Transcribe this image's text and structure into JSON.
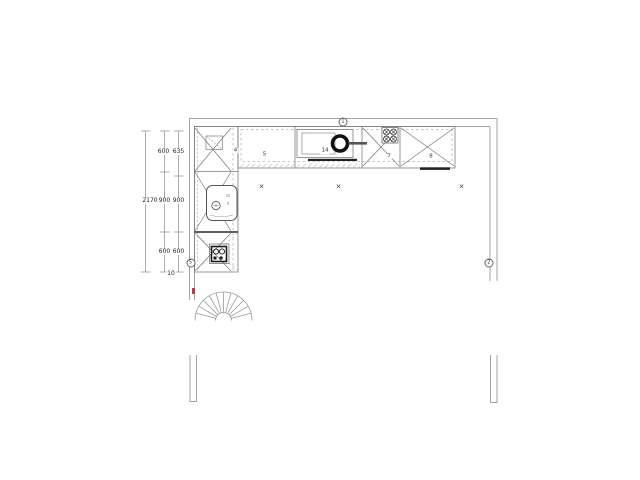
{
  "dims": {
    "total": "2170",
    "inner": [
      "600",
      "900",
      "600"
    ],
    "outer": [
      "635",
      "900",
      "600"
    ],
    "gap": "10"
  },
  "wall_markers": {
    "top": "1",
    "right": "2",
    "left": "5"
  },
  "unit_labels": {
    "corner": "4",
    "counter": "5",
    "sink_run": "14",
    "hob": "7",
    "cabinet": "8"
  },
  "sink_notes": [
    "12",
    "3"
  ],
  "floor_marks": {
    "cross": "×"
  },
  "colors": {
    "wall": "#a3a3a3",
    "cabinet_line": "#7d7d7d",
    "dark": "#1a1a1a",
    "accent": "#b43c3c"
  }
}
